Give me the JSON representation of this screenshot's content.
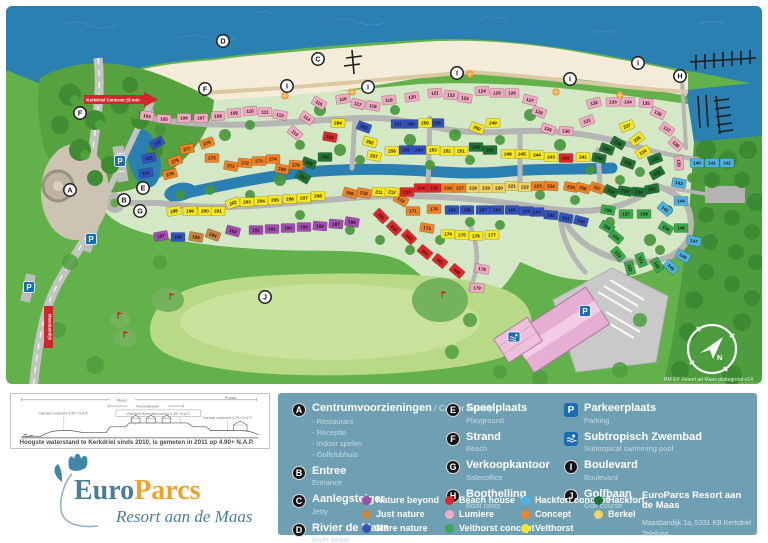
{
  "map": {
    "signs": {
      "kerkdriel": "Kerkdriel Centrum ±5 min",
      "dike": "Maasbandijk"
    },
    "compass_letter": "N",
    "version": "BM-EP Resort ad Maas-plattegrond-v14",
    "markers": [
      [
        "A",
        70,
        190
      ],
      [
        "B",
        124,
        200
      ],
      [
        "C",
        318,
        59
      ],
      [
        "D",
        223,
        41
      ],
      [
        "E",
        143,
        188
      ],
      [
        "F",
        205,
        89
      ],
      [
        "F",
        80,
        113
      ],
      [
        "G",
        140,
        211
      ],
      [
        "H",
        680,
        76
      ],
      [
        "I",
        287,
        86
      ],
      [
        "I",
        368,
        87
      ],
      [
        "I",
        457,
        73
      ],
      [
        "I",
        570,
        79
      ],
      [
        "I",
        638,
        63
      ],
      [
        "J",
        265,
        297
      ]
    ],
    "parking_markers": [
      [
        120,
        161
      ],
      [
        91,
        239
      ],
      [
        29,
        287
      ],
      [
        585,
        311
      ]
    ],
    "swim_markers": [
      [
        514,
        337
      ]
    ],
    "golf_flags": [
      [
        170,
        300
      ],
      [
        118,
        319
      ],
      [
        124,
        338
      ],
      [
        442,
        298
      ]
    ],
    "beach_umbrellas": [
      [
        285,
        96
      ],
      [
        352,
        92
      ],
      [
        470,
        74
      ],
      [
        556,
        92
      ],
      [
        620,
        95
      ]
    ],
    "lot_colors": {
      "L": "#f2a9c6",
      "B": "#e0262a",
      "M": "#3053c4",
      "K": "#4ab3e6",
      "V": "#f6e81e",
      "Y": "#f0d463",
      "C": "#f08124",
      "N": "#c98443",
      "P": "#a04cb4",
      "G": "#3aa94d",
      "H": "#1d7436"
    },
    "lots": [
      [
        101,
        "M",
        146,
        173,
        -10
      ],
      [
        102,
        "M",
        149,
        158,
        -10
      ],
      [
        103,
        "M",
        157,
        143,
        -30
      ],
      [
        104,
        "L",
        147,
        116,
        8
      ],
      [
        105,
        "L",
        164,
        119,
        4
      ],
      [
        106,
        "L",
        184,
        118,
        0
      ],
      [
        107,
        "L",
        201,
        118,
        0
      ],
      [
        108,
        "L",
        218,
        116,
        -3
      ],
      [
        109,
        "L",
        234,
        113,
        -5
      ],
      [
        110,
        "L",
        250,
        111,
        -5
      ],
      [
        111,
        "L",
        265,
        112,
        0
      ],
      [
        112,
        "L",
        280,
        115,
        10
      ],
      [
        113,
        "L",
        295,
        133,
        40
      ],
      [
        114,
        "L",
        307,
        118,
        35
      ],
      [
        115,
        "L",
        319,
        103,
        30
      ],
      [
        116,
        "L",
        343,
        99,
        -8
      ],
      [
        117,
        "L",
        358,
        104,
        15
      ],
      [
        118,
        "L",
        373,
        106,
        10
      ],
      [
        119,
        "L",
        389,
        100,
        -5
      ],
      [
        120,
        "L",
        412,
        97,
        -8
      ],
      [
        121,
        "L",
        435,
        93,
        -5
      ],
      [
        122,
        "L",
        451,
        95,
        5
      ],
      [
        123,
        "L",
        465,
        98,
        8
      ],
      [
        124,
        "L",
        482,
        91,
        -3
      ],
      [
        125,
        "L",
        497,
        93,
        0
      ],
      [
        126,
        "L",
        512,
        93,
        0
      ],
      [
        127,
        "L",
        530,
        100,
        15
      ],
      [
        128,
        "L",
        539,
        112,
        20
      ],
      [
        129,
        "L",
        548,
        129,
        20
      ],
      [
        130,
        "L",
        566,
        131,
        5
      ],
      [
        131,
        "L",
        587,
        121,
        -20
      ],
      [
        132,
        "L",
        594,
        103,
        -15
      ],
      [
        133,
        "L",
        613,
        102,
        0
      ],
      [
        134,
        "L",
        628,
        102,
        0
      ],
      [
        135,
        "L",
        646,
        103,
        5
      ],
      [
        136,
        "L",
        658,
        113,
        25
      ],
      [
        137,
        "L",
        667,
        129,
        35
      ],
      [
        138,
        "L",
        676,
        144,
        40
      ],
      [
        139,
        "L",
        679,
        163,
        85
      ],
      [
        140,
        "K",
        697,
        163,
        0
      ],
      [
        141,
        "K",
        712,
        163,
        0
      ],
      [
        142,
        "K",
        727,
        163,
        0
      ],
      [
        143,
        "K",
        679,
        183,
        10
      ],
      [
        144,
        "K",
        681,
        201,
        0
      ],
      [
        145,
        "K",
        665,
        209,
        40
      ],
      [
        146,
        "G",
        681,
        228,
        0
      ],
      [
        147,
        "K",
        694,
        241,
        10
      ],
      [
        148,
        "K",
        683,
        256,
        30
      ],
      [
        149,
        "K",
        671,
        267,
        45
      ],
      [
        150,
        "G",
        657,
        265,
        60
      ],
      [
        151,
        "G",
        641,
        260,
        70
      ],
      [
        152,
        "G",
        630,
        268,
        75
      ],
      [
        153,
        "G",
        618,
        254,
        50
      ],
      [
        154,
        "G",
        616,
        237,
        40
      ],
      [
        155,
        "G",
        607,
        227,
        30
      ],
      [
        156,
        "G",
        608,
        210,
        10
      ],
      [
        157,
        "G",
        626,
        214,
        0
      ],
      [
        158,
        "G",
        644,
        214,
        0
      ],
      [
        159,
        "G",
        666,
        228,
        30
      ],
      [
        160,
        "M",
        581,
        221,
        15
      ],
      [
        161,
        "M",
        566,
        218,
        10
      ],
      [
        162,
        "M",
        551,
        215,
        5
      ],
      [
        163,
        "M",
        537,
        212,
        0
      ],
      [
        164,
        "M",
        526,
        211,
        0
      ],
      [
        165,
        "M",
        512,
        210,
        0
      ],
      [
        166,
        "M",
        497,
        210,
        0
      ],
      [
        167,
        "M",
        483,
        210,
        0
      ],
      [
        168,
        "M",
        467,
        210,
        0
      ],
      [
        169,
        "M",
        452,
        210,
        0
      ],
      [
        170,
        "C",
        434,
        209,
        0
      ],
      [
        171,
        "C",
        413,
        211,
        0
      ],
      [
        172,
        "C",
        401,
        200,
        30
      ],
      [
        173,
        "C",
        427,
        228,
        10
      ],
      [
        174,
        "V",
        448,
        234,
        0
      ],
      [
        175,
        "V",
        462,
        235,
        0
      ],
      [
        176,
        "V",
        476,
        236,
        0
      ],
      [
        177,
        "V",
        492,
        235,
        0
      ],
      [
        178,
        "L",
        482,
        269,
        10
      ],
      [
        179,
        "L",
        477,
        288,
        0
      ],
      [
        180,
        "B",
        457,
        271,
        40
      ],
      [
        181,
        "B",
        440,
        261,
        40
      ],
      [
        182,
        "B",
        425,
        252,
        40
      ],
      [
        183,
        "B",
        409,
        237,
        45
      ],
      [
        184,
        "B",
        394,
        228,
        45
      ],
      [
        185,
        "B",
        381,
        216,
        45
      ],
      [
        186,
        "P",
        352,
        222,
        10
      ],
      [
        187,
        "P",
        336,
        224,
        5
      ],
      [
        188,
        "P",
        320,
        226,
        5
      ],
      [
        189,
        "P",
        304,
        227,
        0
      ],
      [
        190,
        "P",
        288,
        228,
        0
      ],
      [
        191,
        "P",
        272,
        229,
        0
      ],
      [
        192,
        "P",
        256,
        230,
        0
      ],
      [
        193,
        "P",
        233,
        231,
        15
      ],
      [
        194,
        "N",
        213,
        235,
        20
      ],
      [
        195,
        "N",
        196,
        237,
        10
      ],
      [
        196,
        "M",
        178,
        237,
        0
      ],
      [
        197,
        "P",
        161,
        236,
        -10
      ],
      [
        198,
        "V",
        174,
        211,
        -10
      ],
      [
        199,
        "V",
        190,
        211,
        0
      ],
      [
        200,
        "V",
        205,
        211,
        0
      ],
      [
        201,
        "V",
        218,
        211,
        0
      ],
      [
        202,
        "V",
        233,
        203,
        -20
      ],
      [
        203,
        "V",
        247,
        202,
        0
      ],
      [
        204,
        "V",
        261,
        201,
        0
      ],
      [
        205,
        "V",
        275,
        200,
        0
      ],
      [
        206,
        "V",
        290,
        199,
        0
      ],
      [
        207,
        "V",
        304,
        198,
        0
      ],
      [
        208,
        "V",
        318,
        196,
        0
      ],
      [
        209,
        "C",
        350,
        193,
        15
      ],
      [
        210,
        "C",
        364,
        193,
        10
      ],
      [
        211,
        "V",
        379,
        192,
        5
      ],
      [
        212,
        "V",
        392,
        192,
        5
      ],
      [
        213,
        "B",
        407,
        192,
        0
      ],
      [
        214,
        "B",
        421,
        188,
        0
      ],
      [
        215,
        "B",
        434,
        188,
        0
      ],
      [
        216,
        "C",
        448,
        188,
        0
      ],
      [
        217,
        "C",
        460,
        188,
        0
      ],
      [
        218,
        "Y",
        473,
        188,
        0
      ],
      [
        219,
        "Y",
        486,
        188,
        0
      ],
      [
        220,
        "Y",
        499,
        188,
        0
      ],
      [
        221,
        "Y",
        512,
        186,
        0
      ],
      [
        222,
        "Y",
        525,
        187,
        0
      ],
      [
        223,
        "C",
        538,
        186,
        0
      ],
      [
        224,
        "C",
        551,
        186,
        5
      ],
      [
        225,
        "C",
        571,
        187,
        10
      ],
      [
        226,
        "C",
        583,
        188,
        15
      ],
      [
        227,
        "C",
        597,
        188,
        20
      ],
      [
        228,
        "H",
        611,
        191,
        25
      ],
      [
        229,
        "H",
        625,
        191,
        10
      ],
      [
        230,
        "H",
        639,
        192,
        5
      ],
      [
        231,
        "H",
        652,
        189,
        -10
      ],
      [
        232,
        "H",
        657,
        173,
        -30
      ],
      [
        233,
        "H",
        655,
        159,
        -20
      ],
      [
        234,
        "V",
        643,
        152,
        -30
      ],
      [
        235,
        "V",
        637,
        139,
        -35
      ],
      [
        236,
        "H",
        628,
        163,
        20
      ],
      [
        237,
        "V",
        627,
        126,
        -20
      ],
      [
        238,
        "H",
        618,
        143,
        30
      ],
      [
        239,
        "H",
        607,
        149,
        20
      ],
      [
        240,
        "H",
        599,
        158,
        10
      ],
      [
        241,
        "V",
        583,
        157,
        0
      ],
      [
        242,
        "B",
        566,
        158,
        0
      ],
      [
        243,
        "V",
        551,
        157,
        0
      ],
      [
        244,
        "V",
        537,
        155,
        0
      ],
      [
        245,
        "V",
        522,
        154,
        0
      ],
      [
        246,
        "V",
        508,
        154,
        0
      ],
      [
        247,
        "H",
        490,
        150,
        0
      ],
      [
        248,
        "H",
        476,
        147,
        0
      ],
      [
        249,
        "V",
        493,
        123,
        0
      ],
      [
        250,
        "V",
        477,
        128,
        20
      ],
      [
        251,
        "V",
        461,
        151,
        0
      ],
      [
        252,
        "V",
        447,
        151,
        0
      ],
      [
        253,
        "V",
        433,
        150,
        0
      ],
      [
        254,
        "M",
        419,
        150,
        0
      ],
      [
        255,
        "M",
        406,
        150,
        0
      ],
      [
        256,
        "V",
        392,
        151,
        0
      ],
      [
        257,
        "V",
        374,
        156,
        10
      ],
      [
        258,
        "M",
        437,
        123,
        0
      ],
      [
        259,
        "V",
        425,
        123,
        0
      ],
      [
        260,
        "M",
        411,
        124,
        0
      ],
      [
        261,
        "M",
        398,
        124,
        0
      ],
      [
        262,
        "V",
        370,
        142,
        15
      ],
      [
        263,
        "M",
        364,
        127,
        20
      ],
      [
        264,
        "V",
        338,
        123,
        0
      ],
      [
        265,
        "B",
        330,
        137,
        10
      ],
      [
        266,
        "H",
        325,
        157,
        0
      ],
      [
        267,
        "H",
        303,
        177,
        30
      ],
      [
        268,
        "H",
        309,
        163,
        20
      ],
      [
        269,
        "C",
        282,
        169,
        10
      ],
      [
        270,
        "C",
        296,
        165,
        5
      ],
      [
        271,
        "C",
        231,
        166,
        10
      ],
      [
        272,
        "C",
        245,
        163,
        5
      ],
      [
        273,
        "C",
        259,
        161,
        0
      ],
      [
        274,
        "C",
        273,
        159,
        0
      ],
      [
        275,
        "C",
        212,
        158,
        0
      ],
      [
        276,
        "C",
        207,
        143,
        -20
      ],
      [
        277,
        "C",
        187,
        149,
        -10
      ],
      [
        278,
        "C",
        175,
        161,
        -20
      ],
      [
        279,
        "C",
        170,
        174,
        -15
      ]
    ]
  },
  "legend": {
    "facilities": [
      {
        "key": "A",
        "title": "Centrumvoorzieningen",
        "suffix": "/ Center Facility",
        "items": [
          "- Restaurant",
          "- Receptie",
          "- Indoor spelen",
          "- Golfclubhuis"
        ]
      },
      {
        "key": "B",
        "title": "Entree",
        "sub": "Entrance"
      },
      {
        "key": "C",
        "title": "Aanlegsteiger",
        "sub": "Jetty"
      },
      {
        "key": "D",
        "title": "Rivier de Maas",
        "sub": "River Maas"
      },
      {
        "key": "E",
        "title": "Speelplaats",
        "sub": "Playground"
      },
      {
        "key": "F",
        "title": "Strand",
        "sub": "Beach"
      },
      {
        "key": "G",
        "title": "Verkoopkantoor",
        "sub": "Salesoffice"
      },
      {
        "key": "H",
        "title": "Boothelling",
        "sub": "Boat ramp"
      },
      {
        "key": "P",
        "icon": "parking",
        "title": "Parkeerplaats",
        "sub": "Parking"
      },
      {
        "key": "Z",
        "icon": "swim",
        "title": "Subtropisch Zwembad",
        "sub": "Subtropical swimming pool"
      },
      {
        "key": "I",
        "title": "Boulevard",
        "sub": "Boulevard"
      },
      {
        "key": "J",
        "title": "Golfbaan",
        "sub": "Golf course"
      }
    ],
    "concepts": [
      {
        "label": "Nature beyond",
        "color": "#a04cb4"
      },
      {
        "label": "Just nature",
        "color": "#c98443"
      },
      {
        "label": "More nature",
        "color": "#3053c4"
      },
      {
        "label": "Beach house",
        "color": "#e0262a"
      },
      {
        "label": "Lumiere",
        "color": "#f2a9c6"
      },
      {
        "label": "Velthorst concept",
        "color": "#3aa94d"
      },
      {
        "label": "Hackfort concept",
        "color": "#4ab3e6"
      },
      {
        "label": "Concept",
        "color": "#f08124"
      },
      {
        "label": "Velthorst",
        "color": "#f6e81e"
      },
      {
        "label": "Hackfort",
        "color": "#1d7436"
      },
      {
        "label": "Berkel",
        "color": "#f0d463"
      }
    ],
    "address": {
      "title": "EuroParcs Resort aan de Maas",
      "line1": "Maasbandijk 1a, 5331 KB Kerkdriel",
      "line2": "Telefoon"
    }
  },
  "diagram": {
    "caption": "Hoogste waterstand te Kerkdriel sinds 2010, is gemeten in 2011 op 4.90+ N.A.P.",
    "span_left": "Maas",
    "span_mid": "Recreatiepark",
    "span_right": "Polder",
    "label_left": "Nieuwe maaiveld 4,25+ N.A.P.",
    "label_mid": "Vloerpeil Recreatiewoning 5,35+ N.A.P.",
    "label_right": "Nieuwe maaiveld 4,25+ N.A.P."
  },
  "logo": {
    "euro": "Euro",
    "parcs": "Parcs",
    "subtitle": "Resort aan de Maas"
  }
}
